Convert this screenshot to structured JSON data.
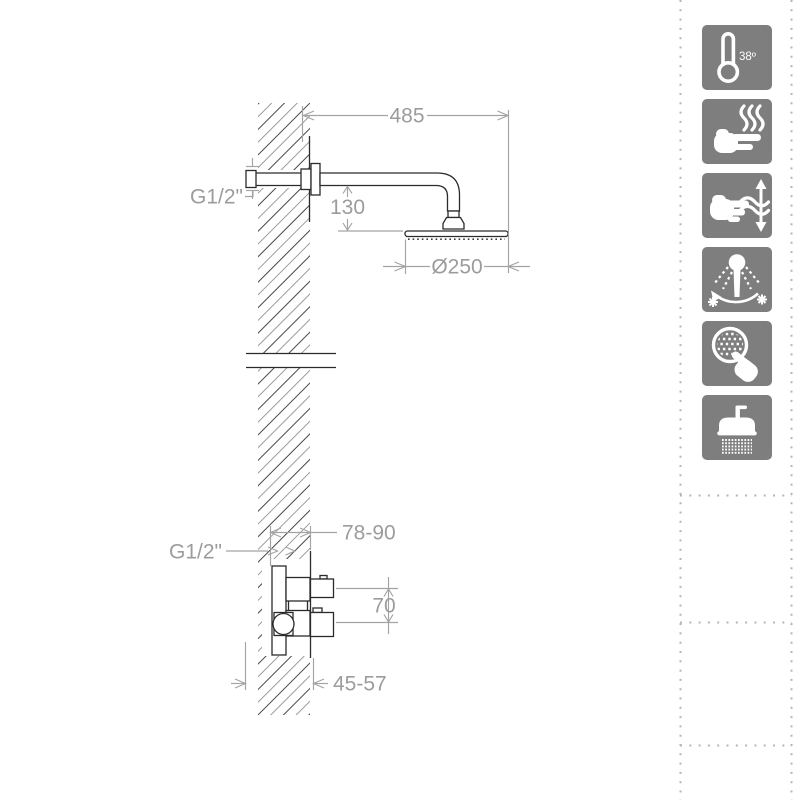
{
  "drawing": {
    "labels": {
      "arm_length": "485",
      "head_drop": "130",
      "head_diameter": "Ø250",
      "arm_thread": "G1/2\"",
      "valve_depth_range": "78-90",
      "valve_thread": "G1/2\"",
      "outlet_spacing": "70",
      "valve_projection_range": "45-57"
    }
  },
  "feature_icons": [
    {
      "name": "thermostat-38-icon",
      "label": "38º"
    },
    {
      "name": "hot-water-hand-icon"
    },
    {
      "name": "flow-control-hand-icon"
    },
    {
      "name": "temperature-lever-icon"
    },
    {
      "name": "easy-clean-spray-face-icon"
    },
    {
      "name": "rain-shower-head-icon"
    }
  ],
  "colors": {
    "line": "#2b2b2b",
    "dimension": "#a3a3a3",
    "dimension_text": "#9c9c9c",
    "tile": "#7e7e7e",
    "dotted_guide": "#b5b5b5"
  }
}
